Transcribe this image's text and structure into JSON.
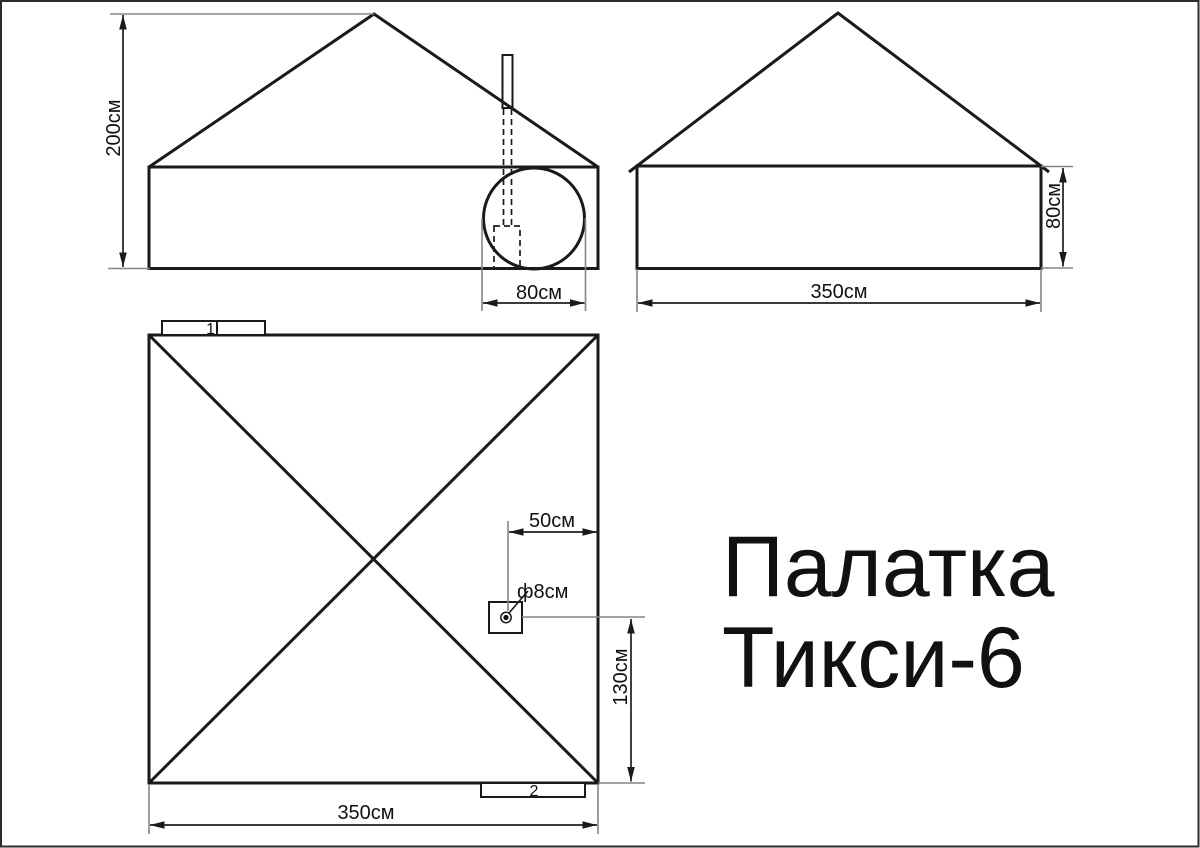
{
  "title": {
    "line1": "Палатка",
    "line2": "Тикси-6"
  },
  "front_view": {
    "height_dim": "200см",
    "entrance_width_dim": "80см"
  },
  "side_view": {
    "wall_height_dim": "80см",
    "length_dim": "350см"
  },
  "plan_view": {
    "tab1_label": "1",
    "tab2_label": "2",
    "chimney_offset_dim": "50см",
    "chimney_diameter_dim": "ф8см",
    "chimney_edge_distance_dim": "130см",
    "width_dim": "350см"
  },
  "colors": {
    "line": "#1a1a1a",
    "extension_line": "#858585",
    "text": "#111111",
    "background": "#ffffff",
    "border": "#2b2b2b"
  }
}
